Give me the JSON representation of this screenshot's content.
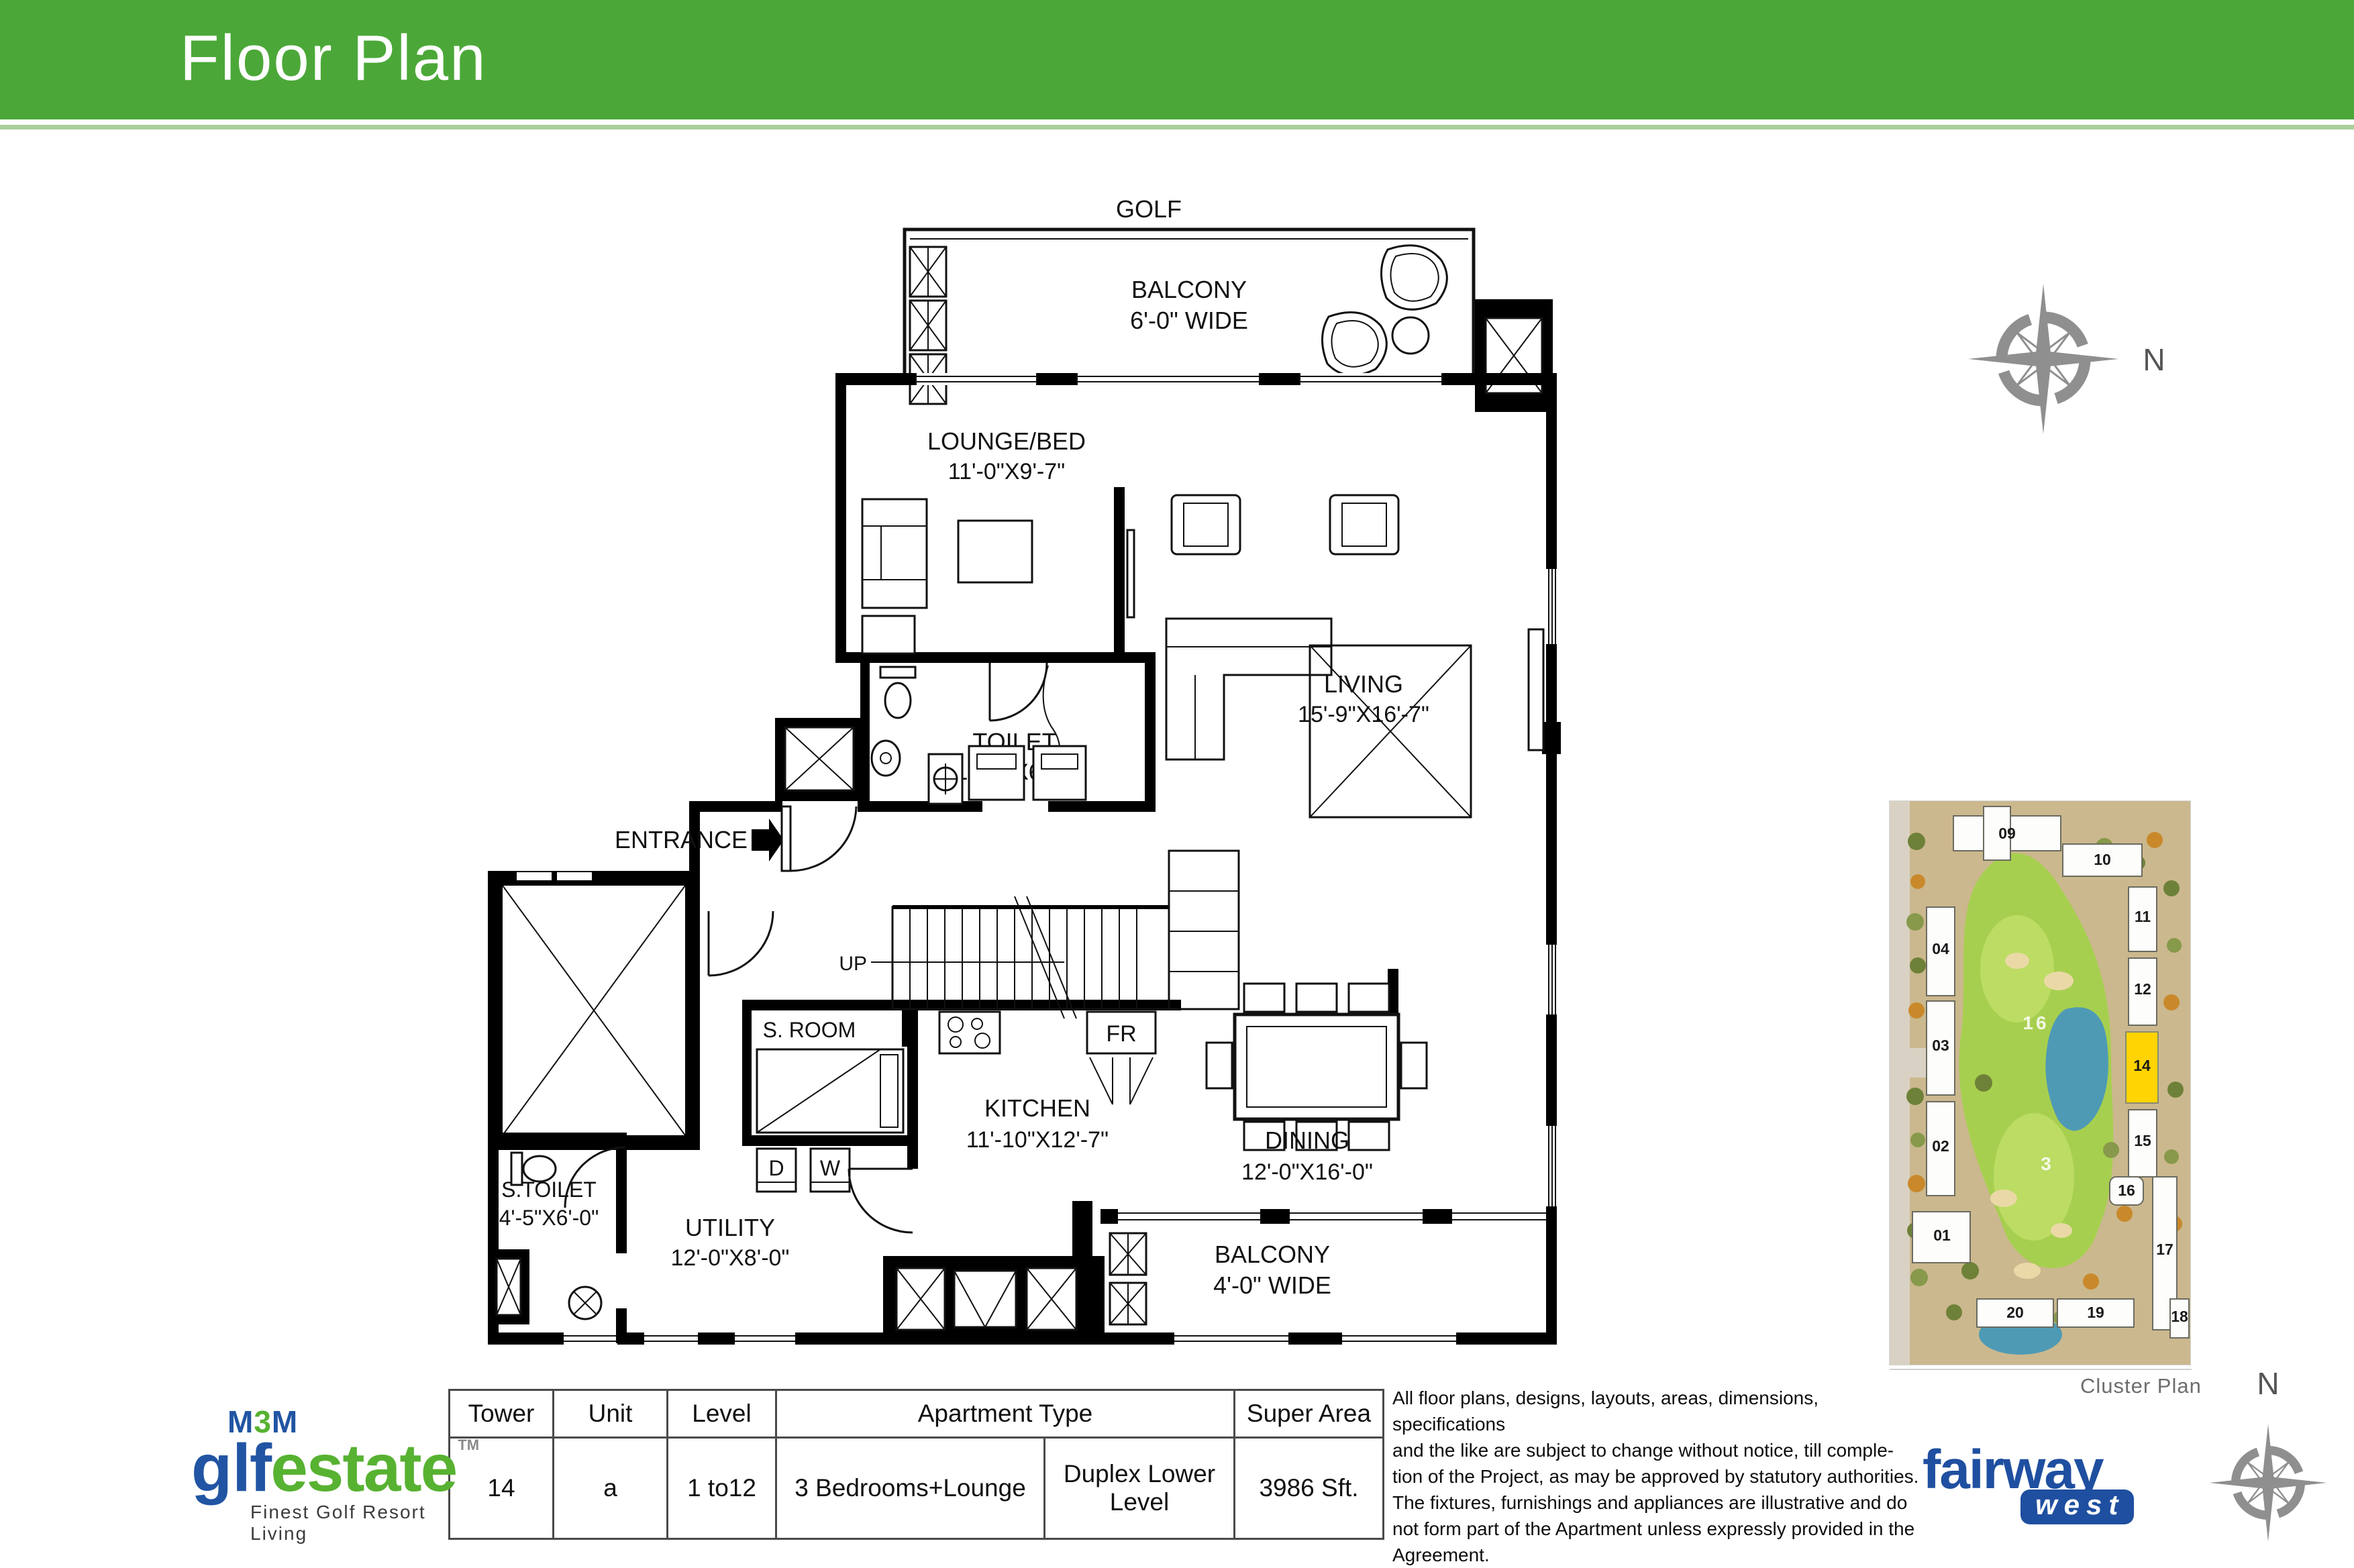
{
  "header": {
    "title": "Floor Plan"
  },
  "colors": {
    "header_green": "#4BA838",
    "band_green": "#A9CF9B",
    "m3m_blue": "#2155A3",
    "m3m_green": "#57B231",
    "fairway_blue": "#1F4FA0",
    "highlight_yellow": "#FFD400"
  },
  "floor_plan": {
    "golf": "GOLF",
    "entrance": "ENTRANCE",
    "up": "UP",
    "fr": "FR",
    "dryer": "D",
    "washer": "W",
    "rooms": {
      "balcony_top": {
        "name": "BALCONY",
        "dim": "6'-0\" WIDE"
      },
      "lounge": {
        "name": "LOUNGE/BED",
        "dim": "11'-0\"X9'-7\""
      },
      "living": {
        "name": "LIVING",
        "dim": "15'-9\"X16'-7\""
      },
      "toilet": {
        "name": "TOILET",
        "dim": "10'-0\"X6'-3\""
      },
      "s_room": {
        "name": "S. ROOM",
        "dim": "9'-0\"X5'-0\""
      },
      "kitchen": {
        "name": "KITCHEN",
        "dim": "11'-10\"X12'-7\""
      },
      "dining": {
        "name": "DINING",
        "dim": "12'-0\"X16'-0\""
      },
      "s_toilet": {
        "name": "S.TOILET",
        "dim": "4'-5\"X6'-0\""
      },
      "utility": {
        "name": "UTILITY",
        "dim": "12'-0\"X8'-0\""
      },
      "balcony_bottom": {
        "name": "BALCONY",
        "dim": "4'-0\" WIDE"
      }
    }
  },
  "compass": {
    "north": "N"
  },
  "cluster_plan": {
    "caption": "Cluster Plan",
    "highlighted": "14",
    "buildings": {
      "b01": "01",
      "b02": "02",
      "b03": "03",
      "b04": "04",
      "b09": "09",
      "b10": "10",
      "b11": "11",
      "b12": "12",
      "b14": "14",
      "b15": "15",
      "b16": "16",
      "b17": "17",
      "b18": "18",
      "b19": "19",
      "b20": "20"
    },
    "course": {
      "hole_16": "16",
      "hole_3": "3"
    }
  },
  "summary_table": {
    "headers": {
      "tower": "Tower",
      "unit": "Unit",
      "level": "Level",
      "apartment_type": "Apartment Type",
      "super_area": "Super Area"
    },
    "row": {
      "tower": "14",
      "unit": "a",
      "level": "1 to12",
      "apartment_type": "3 Bedrooms+Lounge",
      "apartment_subtype": "Duplex Lower Level",
      "super_area": "3986 Sft."
    }
  },
  "disclaimer": {
    "lines": [
      "All floor plans, designs, layouts, areas, dimensions, specifications",
      "and the like are subject to change without notice, till comple-",
      "tion of the Project, as may be approved by statutory authorities.",
      "The fixtures, furnishings and appliances are illustrative and do",
      "not form part of the Apartment unless expressly provided in the",
      "Agreement."
    ]
  },
  "logos": {
    "m3m": {
      "m_left": "M",
      "three": "3",
      "m_right": "M",
      "golf_g": "g",
      "golf_lf": "lf",
      "estate": "estate",
      "tm": "TM",
      "tagline": "Finest Golf Resort Living"
    },
    "fairway": {
      "name": "fairway",
      "sub": "west"
    }
  }
}
